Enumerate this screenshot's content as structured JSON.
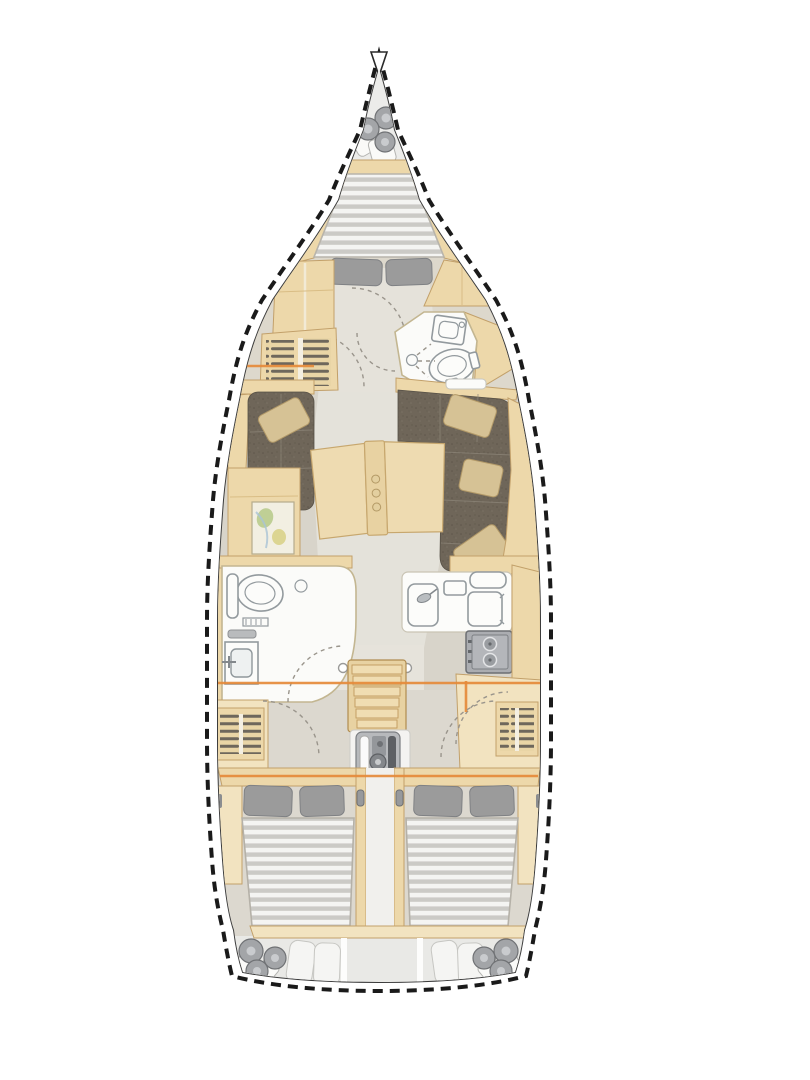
{
  "diagram": {
    "type": "yacht-interior-floorplan",
    "orientation": "bow-top",
    "colors": {
      "outline": "#1a1a1a",
      "inner_line": "#3c3c3c",
      "deck": "#ffffff",
      "floor": "#d9d5cb",
      "floor_light": "#e6e3db",
      "pale": "#ececea",
      "stern_pale": "#e9e9e6",
      "wood": "#edd8aa",
      "wood_light": "#f2e3c0",
      "wood_line": "#c2a06a",
      "sofa": "#6f6659",
      "cushion": "#d6c295",
      "mattress_base": "#cbcac6",
      "mattress_stripe": "#f4f4f2",
      "pillow": "#9b9b9b",
      "fixture_line": "#939a9e",
      "appliance": "#acaeb2",
      "appliance_dark": "#64676b",
      "accent": "#e58a3a",
      "map_green": "#b9cb8d",
      "map_yellow": "#d9d28a"
    },
    "areas": [
      {
        "id": "anchor-locker",
        "items": [
          "fender",
          "fender",
          "mooring-line-coil"
        ]
      },
      {
        "id": "forward-cabin",
        "items": [
          "v-berth-double-bed",
          "pillow",
          "pillow",
          "port-wardrobe",
          "starboard-wardrobe"
        ]
      },
      {
        "id": "forward-head",
        "items": [
          "toilet",
          "sink",
          "shower-drain"
        ]
      },
      {
        "id": "salon",
        "items": [
          "port-settee",
          "settee-cushion",
          "starboard-l-settee",
          "settee-cushion",
          "settee-cushion",
          "settee-cushion",
          "folding-table",
          "chart-table"
        ]
      },
      {
        "id": "galley",
        "items": [
          "sink",
          "faucet",
          "cutting-board",
          "icebox-lid",
          "top-load-fridge",
          "two-burner-stove"
        ]
      },
      {
        "id": "aft-head",
        "items": [
          "toilet",
          "sink",
          "shower-drain",
          "shelf"
        ]
      },
      {
        "id": "companionway",
        "items": [
          "stairs",
          "grab-handle",
          "grab-handle",
          "engine"
        ]
      },
      {
        "id": "port-aft-cabin",
        "items": [
          "double-bed",
          "pillow",
          "pillow",
          "hull-cabinet"
        ]
      },
      {
        "id": "starboard-aft-cabin",
        "items": [
          "double-bed",
          "pillow",
          "pillow",
          "hull-cabinet"
        ]
      },
      {
        "id": "stern-lockers",
        "items": [
          "fender",
          "fender",
          "fender",
          "cushion",
          "cushion",
          "cushion",
          "cushion",
          "fender",
          "fender",
          "fender"
        ]
      }
    ],
    "structure_lines": {
      "accent_bulkheads_y": [
        366,
        683,
        776
      ]
    }
  }
}
